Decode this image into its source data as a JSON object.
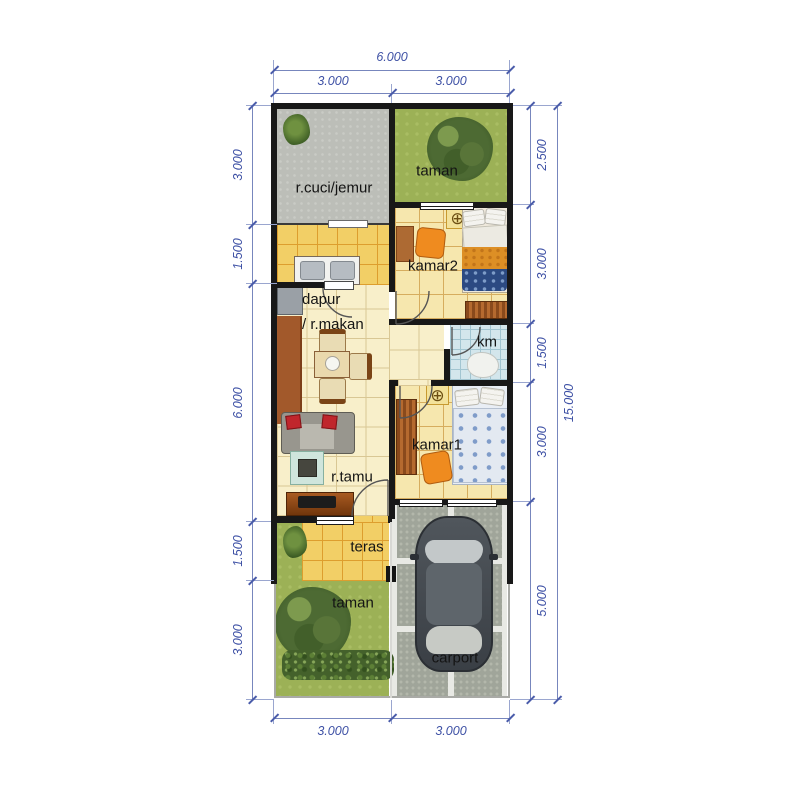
{
  "dimensions": {
    "top": {
      "total": "6.000",
      "segments": [
        "3.000",
        "3.000"
      ]
    },
    "bottom": {
      "segments": [
        "3.000",
        "3.000"
      ]
    },
    "left": {
      "segments": [
        "3.000",
        "1.500",
        "6.000",
        "1.500",
        "3.000"
      ]
    },
    "right": {
      "segments": [
        "2.500",
        "3.000",
        "1.500",
        "3.000",
        "5.000"
      ],
      "total": "15.000"
    }
  },
  "rooms": {
    "laundry": {
      "label": "r.cuci/jemur"
    },
    "garden_top": {
      "label": "taman"
    },
    "bedroom2": {
      "label": "kamar2"
    },
    "kitchen": {
      "label_line1": "dapur",
      "label_line2": "/ r.makan"
    },
    "bathroom": {
      "label": "km"
    },
    "bedroom1": {
      "label": "kamar1"
    },
    "living": {
      "label": "r.tamu"
    },
    "terrace": {
      "label": "teras"
    },
    "garden_bottom": {
      "label": "taman"
    },
    "carport": {
      "label": "carport"
    }
  },
  "icons": {
    "ceiling_fan": "⊕"
  },
  "colors": {
    "wall": "#181818",
    "dimension_text": "#3e51a5",
    "grass": "#9cb156",
    "tile_cream": "#f8efca",
    "tile_yellow": "#f2cf66",
    "bathroom_tile": "#d3e6ec",
    "concrete": "#bcbeb8",
    "paver": "#a0a59a",
    "accent_orange": "#ef8b1f"
  }
}
